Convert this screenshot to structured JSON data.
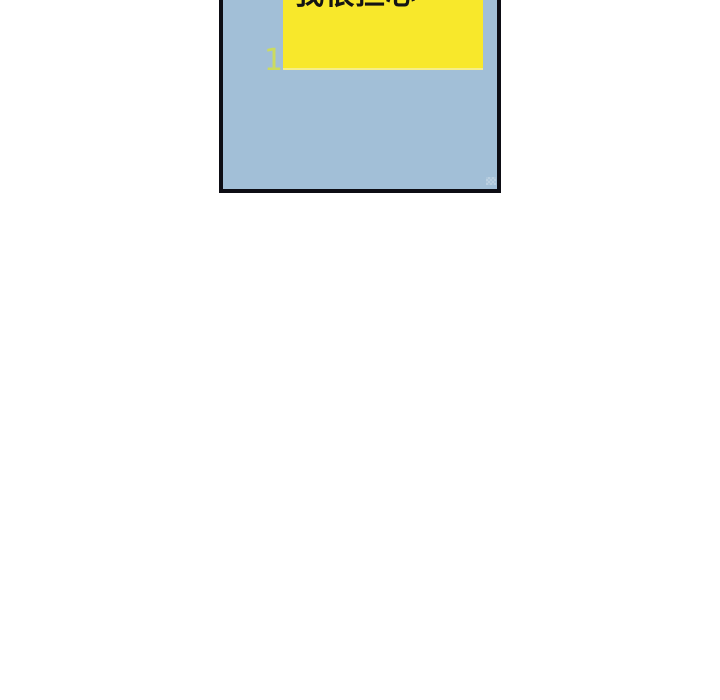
{
  "page": {
    "background_color": "#ffffff",
    "width": 720,
    "height": 700
  },
  "comic_panel": {
    "number": "1",
    "number_color": "#cbdb5f",
    "background_color": "#a2bfd7",
    "border_color": "#0d0d14",
    "clipped_at_top": true,
    "speech_bubble": {
      "text": "我很担心",
      "background_color": "#f8e82b",
      "bottom_edge_color": "#f5ee89",
      "text_color": "#141414",
      "clipped_at_top": true
    }
  }
}
